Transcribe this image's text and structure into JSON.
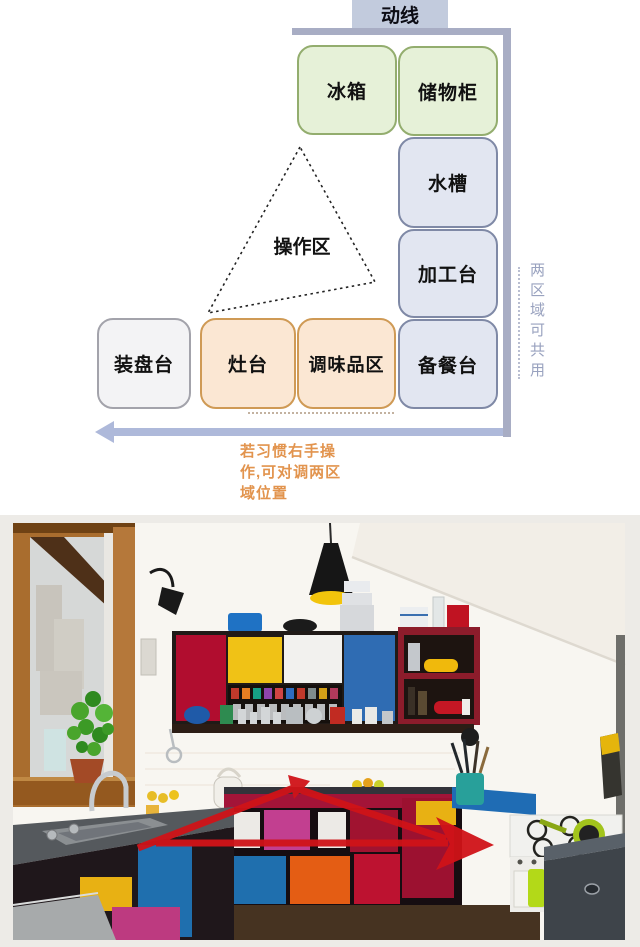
{
  "diagram": {
    "header_label": "动线",
    "nodes": {
      "fridge": "冰箱",
      "storage": "储物柜",
      "sink": "水槽",
      "processing": "加工台",
      "prep": "备餐台",
      "plating": "装盘台",
      "stove": "灶台",
      "seasoning": "调味品区",
      "work_triangle": "操作区"
    },
    "side_note": "两区域可共用",
    "caption_lines": [
      "若习惯右手操",
      "作,可对调两区",
      "域位置"
    ],
    "colors": {
      "wall_bar": "#a8adc4",
      "header_bg": "#c2cbdd",
      "green_fill": "#e6f1d8",
      "green_border": "#93ad6e",
      "blue_fill": "#e2e6f1",
      "blue_border": "#7f89a6",
      "orange_fill": "#fbe7d3",
      "orange_border": "#cf9a55",
      "neutral_fill": "#f3f3f5",
      "neutral_border": "#a3a3ab",
      "flow_arrow": "#aeb9da",
      "caption_text": "#e2944e",
      "side_note_text": "#99a2bf",
      "triangle_stroke": "#222222"
    }
  },
  "photo": {
    "overlay_arrow_color": "#d01318",
    "cabinet_palette": [
      "#b10d2f",
      "#f0c216",
      "#2f6cb3",
      "#efeeeb",
      "#c23f90",
      "#e45d14",
      "#1f6fae",
      "#8c1c2b"
    ]
  }
}
